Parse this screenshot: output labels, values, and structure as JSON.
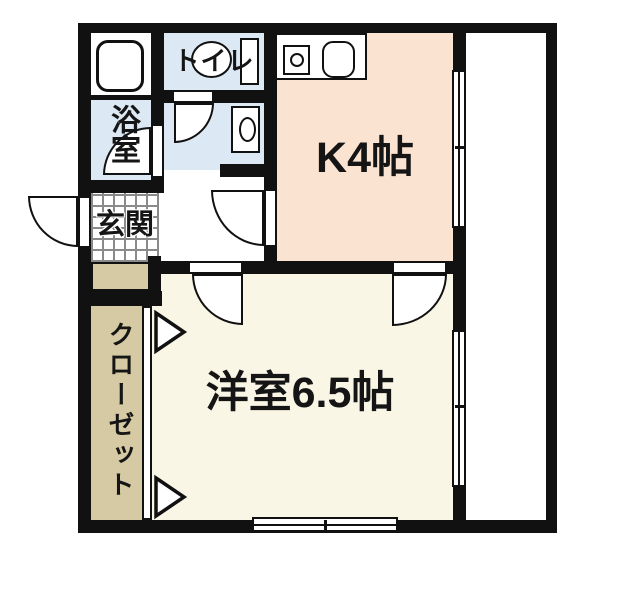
{
  "plan": {
    "type": "apartment-floorplan",
    "rooms": {
      "kitchen": {
        "label": "K4帖"
      },
      "western_room": {
        "label": "洋室6.5帖"
      },
      "bathroom": {
        "label": "浴室"
      },
      "toilet": {
        "label": "トイレ"
      },
      "entrance": {
        "label": "玄関"
      },
      "closet": {
        "label": "クローゼット"
      }
    },
    "fixtures": {
      "bathtub": "bathtub-icon",
      "toilet_bowl": "toilet-icon",
      "washbasin": "washbasin-icon",
      "kitchen_sink": "kitchen-sink-icon",
      "stove_burner": "stove-burner-icon"
    },
    "colors": {
      "wall": "#111111",
      "wet_area": "#dce8f3",
      "kitchen": "#fbe3d1",
      "room": "#faf6e6",
      "closet": "#d6caa4",
      "floor_grid_line": "#8a8a8a",
      "background": "#ffffff"
    }
  }
}
